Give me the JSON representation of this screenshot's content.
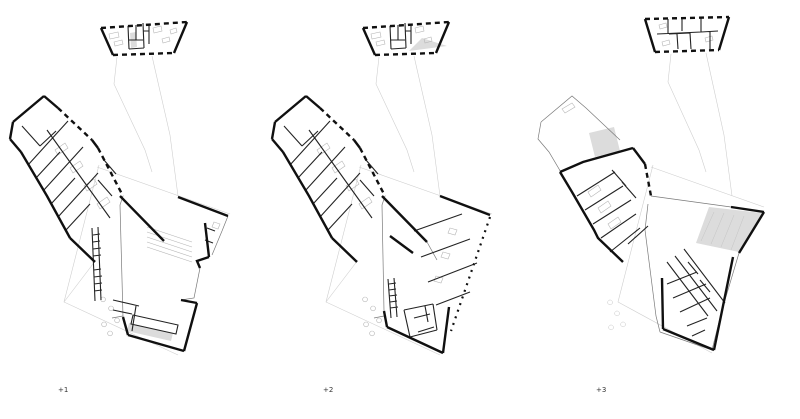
{
  "colors": {
    "background": "#ffffff",
    "ink": "#101010",
    "wall": "#232323",
    "faint": "#cfcfcf",
    "shade": "#dcdcdc",
    "label": "#333333"
  },
  "plans": [
    {
      "label": "+1",
      "paths": {
        "site": "M117,57 L114,84 L145,150 L152,172 M152,56 L170,135 L178,196 M97,167 L230,214 M99,165 L64,302 L178,355 M64,302 L96,260",
        "small_solid": "M101,28 L113,55 M187,22 L174,53",
        "small_dash": "M101,28 L187,22 M113,55 L174,53",
        "small_walls": "M128,26 L129,49 M129,49 L144,48 M144,48 L143,23 M129,40 L143,40 M136,25 L136,40 M143,31 L149,31 M149,24 L149,44",
        "small_shade": "M130,33 L136,32 L137,47 L131,48 Z",
        "small_lite": "M109,34 l9,-2 l1,5 l-9,2 Z M114,42 l8,-2 l1,4 l-8,2 Z M153,28 l8,-2 l1,5 l-8,2 Z M162,39 l7,-2 l1,4 l-7,2 Z M170,30 l6,-2 l1,4 l-6,2 Z",
        "wing_roof": "",
        "wing_shade": "",
        "wing_solid": "M44,96 L13,122 M13,122 L10,139 M10,139 L21,152 M21,152 L47,196 M47,196 L70,238 M70,238 L95,262 M44,96 L58,108 M92,140 L98,148",
        "wing_dash": "M58,108 L92,140 M98,148 L123,196",
        "wing_walls": "M28,165 L68,121 M36,178 L60,152 M43,191 L83,147 M51,204 L75,178 M58,217 L98,173 M66,230 L90,204 M22,126 L40,146 M40,146 L56,131 M47,130 L110,218 M98,180 L112,196 M104,160 L116,174",
        "wing_lite": "M55,150 l10,-7 l3,5 l-10,7 Z M70,168 l10,-7 l3,5 l-10,7 Z M84,186 l10,-7 l3,5 l-10,7 Z M97,204 l10,-7 l3,5 l-10,7 Z",
        "hall_solid": "M178,197 L228,216 M120,196 L164,241 M205,223 L209,257 M209,257 L197,261 L200,268 M181,300 L197,303 M197,303 L184,351 M123,317 L128,335 M128,335 L184,351",
        "hall_dash": "",
        "hall_thin": "M228,216 L222,231 M222,231 L212,255 M200,268 L194,298 L181,300 M123,196 L120,205 L123,317 M112,318 L123,316",
        "hall_walls": "M92,228 L95,301 M98,227 L101,300 M93,235 L100,234 M93,242 L100,241 M93,249 L101,248 M93,256 L101,255 M94,270 L101,269 M94,277 L102,276 M94,284 L102,283 M94,291 L102,290 M133,315 L178,325 L176,334 L131,324 Z M113,300 L139,306 M136,306 L132,331 M113,310 L132,314 M207,228 L215,231 M205,240 L213,243",
        "hall_lite": "M147,227 L192,242 M147,232 L192,247 M147,237 L192,252 M147,242 L192,257 M147,247 L192,262 M103,297 a2.4,2.4 0 1,0 0.1,0 M111,306 a2.4,2.4 0 1,0 0.1,0 M117,318 a2.4,2.4 0 1,0 0.1,0 M104,322 a2.4,2.4 0 1,0 0.1,0 M110,331 a2.4,2.4 0 1,0 0.1,0 M214,222 l6,2 l-2,5 l-6,-2 Z",
        "hall_shade": "M129,323 L173,333 L171,341 L127,331 Z"
      }
    },
    {
      "label": "+2",
      "paths": {
        "site": "M379,57 L376,84 L407,150 L414,172 M414,56 L432,135 L440,196 M359,167 L492,214 M361,165 L326,302 L440,355 M326,302 L358,260",
        "small_solid": "M363,28 L375,55 M449,22 L436,53",
        "small_dash": "M363,28 L449,22 M375,55 L436,53",
        "small_walls": "M390,26 L391,49 M391,49 L406,48 M406,48 L405,23 M391,40 L405,40 M398,25 L398,40 M405,31 L411,31 M411,24 L411,44",
        "small_shade": "M422,38 L447,46 L409,51 Z",
        "small_lite": "M371,34 l9,-2 l1,5 l-9,2 Z M376,42 l8,-2 l1,4 l-8,2 Z M415,28 l8,-2 l1,5 l-8,2 Z M424,39 l7,-2 l1,4 l-7,2 Z",
        "wing_roof": "",
        "wing_shade": "",
        "wing_solid": "M306,96 L275,122 M275,122 L272,139 M272,139 L283,152 M283,152 L309,196 M309,196 L332,238 M332,238 L357,262 M306,96 L320,108 M354,140 L360,148",
        "wing_dash": "M320,108 L354,140 M360,148 L385,196",
        "wing_walls": "M290,165 L330,121 M298,178 L322,152 M305,191 L345,147 M313,204 L337,178 M320,217 L360,173 M328,230 L352,204 M284,126 L302,146 M302,146 L318,131 M309,130 L372,218 M360,180 L374,196 M366,160 L378,174",
        "wing_lite": "M317,150 l10,-7 l3,5 l-10,7 Z M332,168 l10,-7 l3,5 l-10,7 Z M346,186 l10,-7 l3,5 l-10,7 Z M359,204 l10,-7 l3,5 l-10,7 Z",
        "hall_solid": "M440,196 L490,215 M382,196 L427,242 M390,236 L413,253 M387,327 L443,353 M449,307 L443,353 M384,311 L387,327",
        "hall_dash": "M490,217 L463,296 L451,331",
        "hall_thin": "M385,196 L382,205 L384,311 M374,318 L384,316 M427,242 L437,260",
        "hall_walls": "M414,231 L462,214 M421,257 L470,239 M428,282 L477,263 M436,305 L470,292 M388,279 L391,318 M394,278 L397,317 M389,284 L396,283 M389,290 L396,289 M389,296 L397,295 M390,302 L397,301 M390,308 L398,307 M404,310 L433,304 M433,304 L437,330 M437,330 L410,337 M410,337 L404,310 M414,318 L430,314 M418,332 L434,327 M425,306 L428,322",
        "hall_lite": "M365,297 a2.4,2.4 0 1,0 0.1,0 M373,306 a2.4,2.4 0 1,0 0.1,0 M379,318 a2.4,2.4 0 1,0 0.1,0 M366,322 a2.4,2.4 0 1,0 0.1,0 M372,331 a2.4,2.4 0 1,0 0.1,0 M450,228 l7,2 l-2,5 l-7,-2 Z M443,252 l7,2 l-2,5 l-7,-2 Z M436,276 l7,2 l-2,5 l-7,-2 Z",
        "hall_shade": ""
      }
    },
    {
      "label": "+3",
      "paths": {
        "site": "M671,54 L668,82 L699,150 L706,172 M706,53 L724,135 L732,196 M651,167 L764,207 M653,165 L618,302 L712,353",
        "small_solid": "M645,19 L655,52 M729,17 L719,50",
        "small_dash": "M645,19 L729,17 M655,52 L719,50",
        "small_walls": "M668,19 L668,34 M682,17 L682,31 M657,34 L701,32 M669,34 L690,33 M690,33 L691,49 M677,34 L678,49 M701,17 L701,32 M701,32 L718,31 M710,32 L710,49",
        "small_shade": "",
        "small_lite": "M659,25 l7,-2 l1,4 l-7,2 Z M705,38 l7,-2 l1,4 l-7,2 Z M662,42 l7,-2 l1,4 l-7,2 Z",
        "wing_roof": "M541,122 L572,96 L586,108 L620,140 M541,122 L538,139 L549,152 L575,196",
        "wing_shade": "M589,133 L614,127 L620,151 L595,157 Z",
        "wing_solid": "M560,172 L583,162 L633,148 M633,148 L645,164 M560,172 L572,192 M572,192 L594,230 L598,238 L623,262",
        "wing_dash": "M645,164 L651,196",
        "wing_walls": "M577,196 L615,172 M585,210 L623,186 M593,224 L631,200 M601,238 L636,214 M610,252 L640,228 M612,170 L626,186 M622,182 L636,198 M628,244 L648,226",
        "wing_lite": "M562,109 l10,-6 l3,4 l-10,6 Z M588,192 l10,-7 l3,5 l-10,7 Z M598,208 l10,-7 l3,5 l-10,7 Z M608,224 l10,-7 l3,5 l-10,7 Z",
        "hall_solid": "M731,207 L764,212 M764,212 L739,253 M662,278 L663,329 M663,329 L714,350 M733,257 L714,350",
        "hall_dash": "",
        "hall_thin": "M651,196 L731,207 M648,204 L645,230 L656,316 M656,316 L660,332 M739,253 L722,310 M722,310 L712,350 M712,350 L660,332",
        "hall_walls": "M667,262 L708,316 M675,256 L717,311 M684,249 L725,303 M667,284 L697,272 M673,298 L706,284 M680,312 L710,298 M687,326 L707,318 M692,336 L705,330 M700,280 L710,292 M688,262 L698,274",
        "hall_lite": "M610,300 a2.4,2.4 0 1,0 0.1,0 M617,311 a2.4,2.4 0 1,0 0.1,0 M623,322 a2.4,2.4 0 1,0 0.1,0 M611,325 a2.4,2.4 0 1,0 0.1,0 M714,212 L701,241 M724,213 L711,244 M734,215 L721,247 M744,216 L731,250",
        "hall_shade": "M709,207 L762,213 L739,252 L696,243 Z"
      }
    }
  ]
}
